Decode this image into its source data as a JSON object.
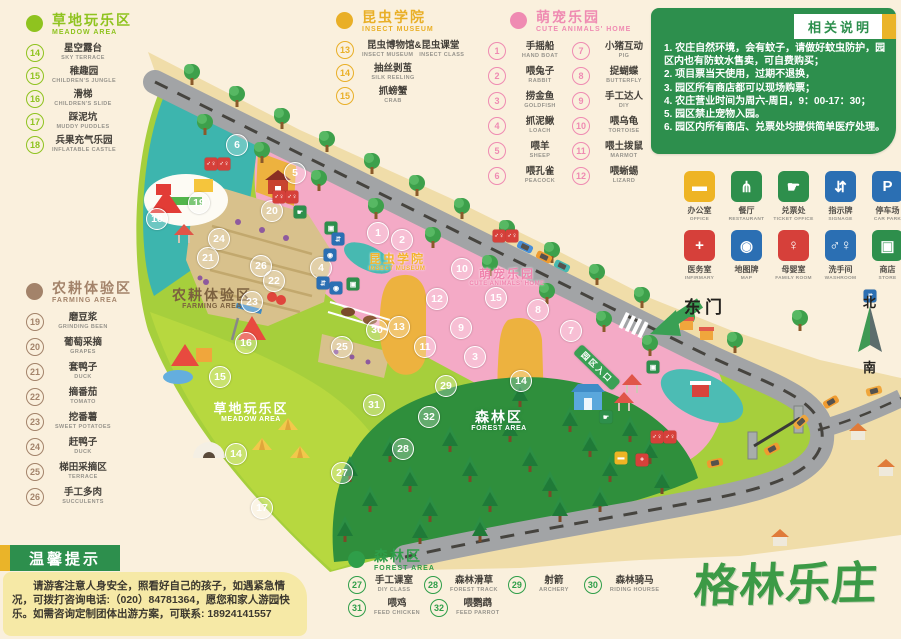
{
  "legends": {
    "meadow": {
      "title": "草地玩乐区",
      "subtitle": "MEADOW AREA",
      "color": "#8fc31f",
      "items": [
        {
          "num": "14",
          "zh": "星空露台",
          "en": "SKY TERRACE"
        },
        {
          "num": "15",
          "zh": "稚趣园",
          "en": "CHILDREN'S JUNGLE"
        },
        {
          "num": "16",
          "zh": "滑梯",
          "en": "CHILDREN'S SLIDE"
        },
        {
          "num": "17",
          "zh": "踩泥坑",
          "en": "MUDDY PUDDLES"
        },
        {
          "num": "18",
          "zh": "兵果充气乐园",
          "en": "INFLATABLE CASTLE"
        }
      ]
    },
    "insect": {
      "title": "昆虫学院",
      "subtitle": "INSECT MUSEUM",
      "color": "#e9af27",
      "items": [
        {
          "num": "13",
          "zh": "昆虫博物馆&昆虫课堂",
          "en": "INSECT MUSEUM　INSECT CLASS"
        },
        {
          "num": "14",
          "zh": "抽丝剥茧",
          "en": "SILK REELING"
        },
        {
          "num": "15",
          "zh": "抓螃蟹",
          "en": "CRAB"
        }
      ]
    },
    "pets": {
      "title": "萌宠乐园",
      "subtitle": "CUTE ANIMALS' HOME",
      "color": "#ef8bb2",
      "items_left": [
        {
          "num": "1",
          "zh": "手摇船",
          "en": "HAND BOAT"
        },
        {
          "num": "2",
          "zh": "喂兔子",
          "en": "RABBIT"
        },
        {
          "num": "3",
          "zh": "捞金鱼",
          "en": "GOLDFISH"
        },
        {
          "num": "4",
          "zh": "抓泥鳅",
          "en": "LOACH"
        },
        {
          "num": "5",
          "zh": "喂羊",
          "en": "SHEEP"
        },
        {
          "num": "6",
          "zh": "喂孔雀",
          "en": "PEACOCK"
        }
      ],
      "items_right": [
        {
          "num": "7",
          "zh": "小猪互动",
          "en": "PIG"
        },
        {
          "num": "8",
          "zh": "捉蝴蝶",
          "en": "BUTTERFLY"
        },
        {
          "num": "9",
          "zh": "手工达人",
          "en": "DIY"
        },
        {
          "num": "10",
          "zh": "喂乌龟",
          "en": "TORTOISE"
        },
        {
          "num": "11",
          "zh": "喂土拨鼠",
          "en": "MARMOT"
        },
        {
          "num": "12",
          "zh": "喂蜥蜴",
          "en": "LIZARD"
        }
      ]
    },
    "farming": {
      "title": "农耕体验区",
      "subtitle": "FARMING AREA",
      "color": "#a3836a",
      "items": [
        {
          "num": "19",
          "zh": "磨豆浆",
          "en": "GRINDING BEEN"
        },
        {
          "num": "20",
          "zh": "葡萄采摘",
          "en": "GRAPES"
        },
        {
          "num": "21",
          "zh": "套鸭子",
          "en": "DUCK"
        },
        {
          "num": "22",
          "zh": "摘番茄",
          "en": "TOMATO"
        },
        {
          "num": "23",
          "zh": "挖番薯",
          "en": "SWEET POTATOES"
        },
        {
          "num": "24",
          "zh": "赶鸭子",
          "en": "DUCK"
        },
        {
          "num": "25",
          "zh": "梯田采摘区",
          "en": "TERRACE"
        },
        {
          "num": "26",
          "zh": "手工多肉",
          "en": "SUCCULENTS"
        }
      ]
    },
    "forest": {
      "title": "森林区",
      "subtitle": "FOREST AREA",
      "color": "#2f9e49",
      "items": [
        {
          "num": "27",
          "zh": "手工课室",
          "en": "DIY CLASS"
        },
        {
          "num": "28",
          "zh": "森林滑草",
          "en": "FOREST TRACK"
        },
        {
          "num": "29",
          "zh": "射箭",
          "en": "ARCHERY"
        },
        {
          "num": "30",
          "zh": "森林骑马",
          "en": "RIDING HOURSE"
        },
        {
          "num": "31",
          "zh": "喂鸡",
          "en": "FEED CHICKEN"
        },
        {
          "num": "32",
          "zh": "喂鹦鹉",
          "en": "FEED PARROT"
        }
      ]
    }
  },
  "notice": {
    "title": "相关说明",
    "bg": "#2d8f4d",
    "accent": "#eab429",
    "lines": [
      "1. 农庄自然环境，会有蚊子，请做好蚊虫防护，园区内也有防蚊水售卖，可自费购买；",
      "2. 项目票当天使用，过期不退换，",
      "3. 园区所有商店都可以现场购票；",
      "4. 农庄营业时间为周六-周日，9：00-17：30；",
      "5. 园区禁止宠物入园。",
      "6. 园区内所有商店、兑票处均提供简单医疗处理。"
    ]
  },
  "facilities": [
    {
      "name": "office",
      "zh": "办公室",
      "en": "OFFICE",
      "color": "#eeb424",
      "glyph": "▬"
    },
    {
      "name": "restaurant",
      "zh": "餐厅",
      "en": "RESTAURANT",
      "color": "#2e8f4c",
      "glyph": "⋔"
    },
    {
      "name": "ticket-office",
      "zh": "兑票处",
      "en": "TICKET OFFICE",
      "color": "#2e8f4c",
      "glyph": "☛"
    },
    {
      "name": "signage",
      "zh": "指示牌",
      "en": "SIGNAGE",
      "color": "#2b6fb3",
      "glyph": "⇵"
    },
    {
      "name": "car-park",
      "zh": "停车场",
      "en": "CAR PARK",
      "color": "#2b6fb3",
      "glyph": "P"
    },
    {
      "name": "infirmary",
      "zh": "医务室",
      "en": "INFIRMARY",
      "color": "#d6403a",
      "glyph": "+"
    },
    {
      "name": "map-board",
      "zh": "地图牌",
      "en": "MAP",
      "color": "#2b6fb3",
      "glyph": "◉"
    },
    {
      "name": "family-room",
      "zh": "母婴室",
      "en": "FAMILY ROOM",
      "color": "#d6403a",
      "glyph": "♀"
    },
    {
      "name": "washroom",
      "zh": "洗手间",
      "en": "WASHROOM",
      "color": "#2b6fb3",
      "glyph": "♂♀"
    },
    {
      "name": "store",
      "zh": "商店",
      "en": "STORE",
      "color": "#2e8f4c",
      "glyph": "▣"
    }
  ],
  "tips": {
    "title": "温馨提示",
    "text": "请游客注意人身安全，照看好自己的孩子，如遇紧急情况，可拨打咨询电话:（020）84781364，愿您和家人游园快乐。如需咨询定制团体出游方案，可联系: 18924141557"
  },
  "logo": {
    "text": "格林乐庄",
    "color": "#3c9a46"
  },
  "map": {
    "east_gate": "东门",
    "entrance_sign": "园区入口",
    "compass": {
      "north": "北",
      "south": "南"
    },
    "labels": [
      {
        "cls": "lb-farm",
        "zh": "农耕体验区",
        "en": "FARMING AREA",
        "x": 212,
        "y": 288
      },
      {
        "cls": "lb-meadow",
        "zh": "草地玩乐区",
        "en": "MEADOW AREA",
        "x": 251,
        "y": 402
      },
      {
        "cls": "lb-forest",
        "zh": "森林区",
        "en": "FOREST AREA",
        "x": 499,
        "y": 410
      },
      {
        "cls": "lb-insect",
        "zh": "昆虫学院",
        "en": "INSECT MUSEUM",
        "x": 397,
        "y": 253
      },
      {
        "cls": "lb-pets",
        "zh": "萌宠乐园",
        "en": "CUTE ANIMALS' HOME",
        "x": 507,
        "y": 268
      }
    ],
    "markers": [
      {
        "n": "1",
        "x": 378,
        "y": 233
      },
      {
        "n": "2",
        "x": 402,
        "y": 240
      },
      {
        "n": "3",
        "x": 475,
        "y": 357
      },
      {
        "n": "4",
        "x": 321,
        "y": 268
      },
      {
        "n": "5",
        "x": 295,
        "y": 173
      },
      {
        "n": "6",
        "x": 237,
        "y": 145
      },
      {
        "n": "7",
        "x": 571,
        "y": 331
      },
      {
        "n": "8",
        "x": 538,
        "y": 310
      },
      {
        "n": "9",
        "x": 461,
        "y": 328
      },
      {
        "n": "10",
        "x": 462,
        "y": 269
      },
      {
        "n": "11",
        "x": 425,
        "y": 347
      },
      {
        "n": "12",
        "x": 437,
        "y": 299
      },
      {
        "n": "13",
        "x": 399,
        "y": 327
      },
      {
        "n": "14",
        "x": 521,
        "y": 381
      },
      {
        "n": "15",
        "x": 496,
        "y": 298
      },
      {
        "n": "14",
        "x": 236,
        "y": 454
      },
      {
        "n": "15",
        "x": 220,
        "y": 377
      },
      {
        "n": "16",
        "x": 246,
        "y": 343
      },
      {
        "n": "17",
        "x": 262,
        "y": 508
      },
      {
        "n": "18",
        "x": 157,
        "y": 219
      },
      {
        "n": "19",
        "x": 199,
        "y": 203
      },
      {
        "n": "20",
        "x": 272,
        "y": 211
      },
      {
        "n": "21",
        "x": 208,
        "y": 258
      },
      {
        "n": "22",
        "x": 274,
        "y": 281
      },
      {
        "n": "23",
        "x": 252,
        "y": 302
      },
      {
        "n": "24",
        "x": 219,
        "y": 239
      },
      {
        "n": "25",
        "x": 342,
        "y": 347
      },
      {
        "n": "26",
        "x": 261,
        "y": 266
      },
      {
        "n": "27",
        "x": 342,
        "y": 473
      },
      {
        "n": "28",
        "x": 403,
        "y": 449
      },
      {
        "n": "29",
        "x": 446,
        "y": 386
      },
      {
        "n": "30",
        "x": 377,
        "y": 330
      },
      {
        "n": "31",
        "x": 374,
        "y": 405
      },
      {
        "n": "32",
        "x": 429,
        "y": 417
      }
    ],
    "mini_icons": [
      {
        "name": "washroom-icon",
        "glyph": "♂♀",
        "color": "#d6403a",
        "x": 211,
        "y": 164
      },
      {
        "name": "washroom-icon",
        "glyph": "♂♀",
        "color": "#d6403a",
        "x": 224,
        "y": 164
      },
      {
        "name": "washroom-icon",
        "glyph": "♂♀",
        "color": "#d6403a",
        "x": 279,
        "y": 197
      },
      {
        "name": "washroom-icon",
        "glyph": "♂♀",
        "color": "#d6403a",
        "x": 292,
        "y": 197
      },
      {
        "name": "washroom-icon",
        "glyph": "♂♀",
        "color": "#d6403a",
        "x": 499,
        "y": 236
      },
      {
        "name": "washroom-icon",
        "glyph": "♂♀",
        "color": "#d6403a",
        "x": 512,
        "y": 236
      },
      {
        "name": "washroom-icon",
        "glyph": "♂♀",
        "color": "#d6403a",
        "x": 657,
        "y": 437
      },
      {
        "name": "washroom-icon",
        "glyph": "♂♀",
        "color": "#d6403a",
        "x": 670,
        "y": 437
      },
      {
        "name": "ticket-icon",
        "glyph": "☛",
        "color": "#2e8f4c",
        "x": 300,
        "y": 212
      },
      {
        "name": "ticket-icon",
        "glyph": "☛",
        "color": "#2e8f4c",
        "x": 606,
        "y": 417
      },
      {
        "name": "store-icon",
        "glyph": "▣",
        "color": "#2e8f4c",
        "x": 331,
        "y": 228
      },
      {
        "name": "store-icon",
        "glyph": "▣",
        "color": "#2e8f4c",
        "x": 353,
        "y": 284
      },
      {
        "name": "store-icon",
        "glyph": "▣",
        "color": "#2e8f4c",
        "x": 653,
        "y": 367
      },
      {
        "name": "signage-icon",
        "glyph": "⇵",
        "color": "#2b6fb3",
        "x": 338,
        "y": 239
      },
      {
        "name": "signage-icon",
        "glyph": "⇵",
        "color": "#2b6fb3",
        "x": 323,
        "y": 283
      },
      {
        "name": "signage-icon",
        "glyph": "⇵",
        "color": "#2b6fb3",
        "x": 870,
        "y": 296
      },
      {
        "name": "map-icon",
        "glyph": "◉",
        "color": "#2b6fb3",
        "x": 330,
        "y": 255
      },
      {
        "name": "map-icon",
        "glyph": "◉",
        "color": "#2b6fb3",
        "x": 336,
        "y": 288
      },
      {
        "name": "office-icon",
        "glyph": "▬",
        "color": "#eeb424",
        "x": 621,
        "y": 458
      },
      {
        "name": "infirmary-icon",
        "glyph": "+",
        "color": "#d6403a",
        "x": 642,
        "y": 460
      }
    ]
  }
}
